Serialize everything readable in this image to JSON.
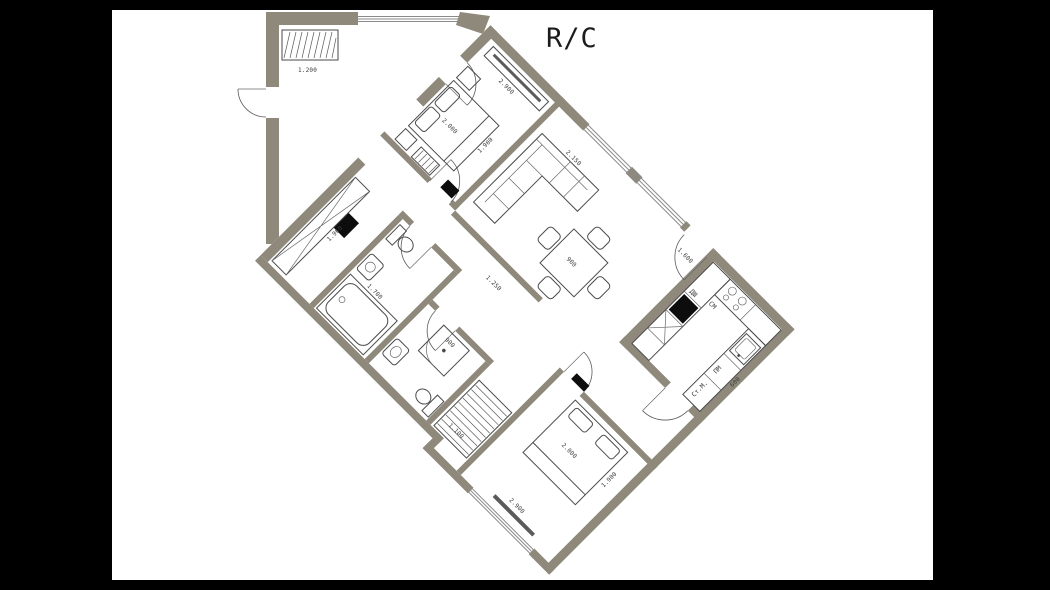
{
  "title": "R/C",
  "colors": {
    "background": "#000000",
    "paper": "#ffffff",
    "wall": "#8e897b",
    "line": "#4a4a4a",
    "marker": "#0d0d0d"
  },
  "kitchen_labels": {
    "oven": "ДШ",
    "microwave": "СМ",
    "dishwasher": "ПМ",
    "washing_machine": "Ст.М."
  },
  "dimensions": {
    "wing_wardrobe": "1.200",
    "bedroom1_cabinet": "2.900",
    "bedroom1_bed_length": "2.000",
    "bedroom1_bed_width": "1.900",
    "sofa": "2.150",
    "table": "900",
    "corridor": "1.250",
    "hall_closet": "1.960",
    "bathtub": "1.700",
    "shower": "900",
    "bedroom2_bed_length": "2.000",
    "bedroom2_bed_width": "1.900",
    "nook_closet": "1.100",
    "bedroom2_window": "2.900",
    "entry": "1.600",
    "kitchen_counter": "600"
  }
}
